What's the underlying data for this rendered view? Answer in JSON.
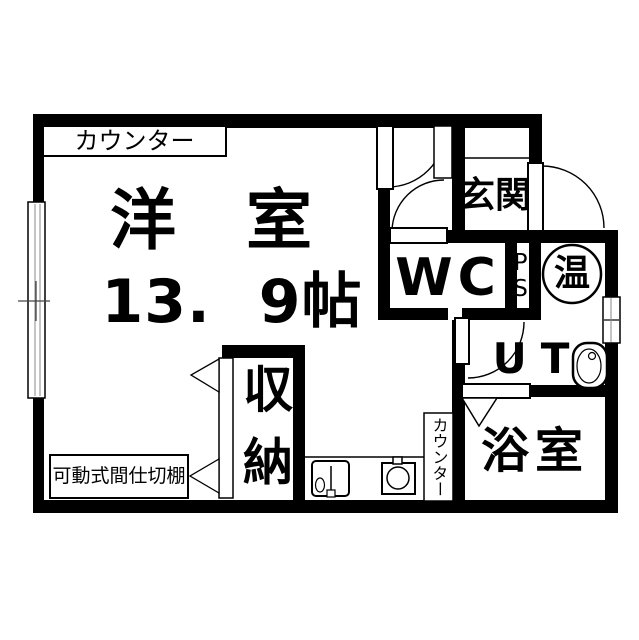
{
  "floorplan": {
    "rooms": {
      "western_room": {
        "name": "洋　室",
        "size": "13. 9帖"
      },
      "entrance": {
        "name": "玄関"
      },
      "toilet": {
        "name": "WC"
      },
      "pipe_space": {
        "name": "PS"
      },
      "water_heater": {
        "name": "温"
      },
      "utility": {
        "name": "UT"
      },
      "bathroom": {
        "name": "浴室"
      },
      "storage": {
        "name": "収納"
      }
    },
    "labels": {
      "counter_top": "カウンター",
      "counter_kitchen": "カウンター",
      "movable_partition": "可動式間仕切棚"
    },
    "colors": {
      "wall": "#000000",
      "background": "#ffffff"
    }
  }
}
